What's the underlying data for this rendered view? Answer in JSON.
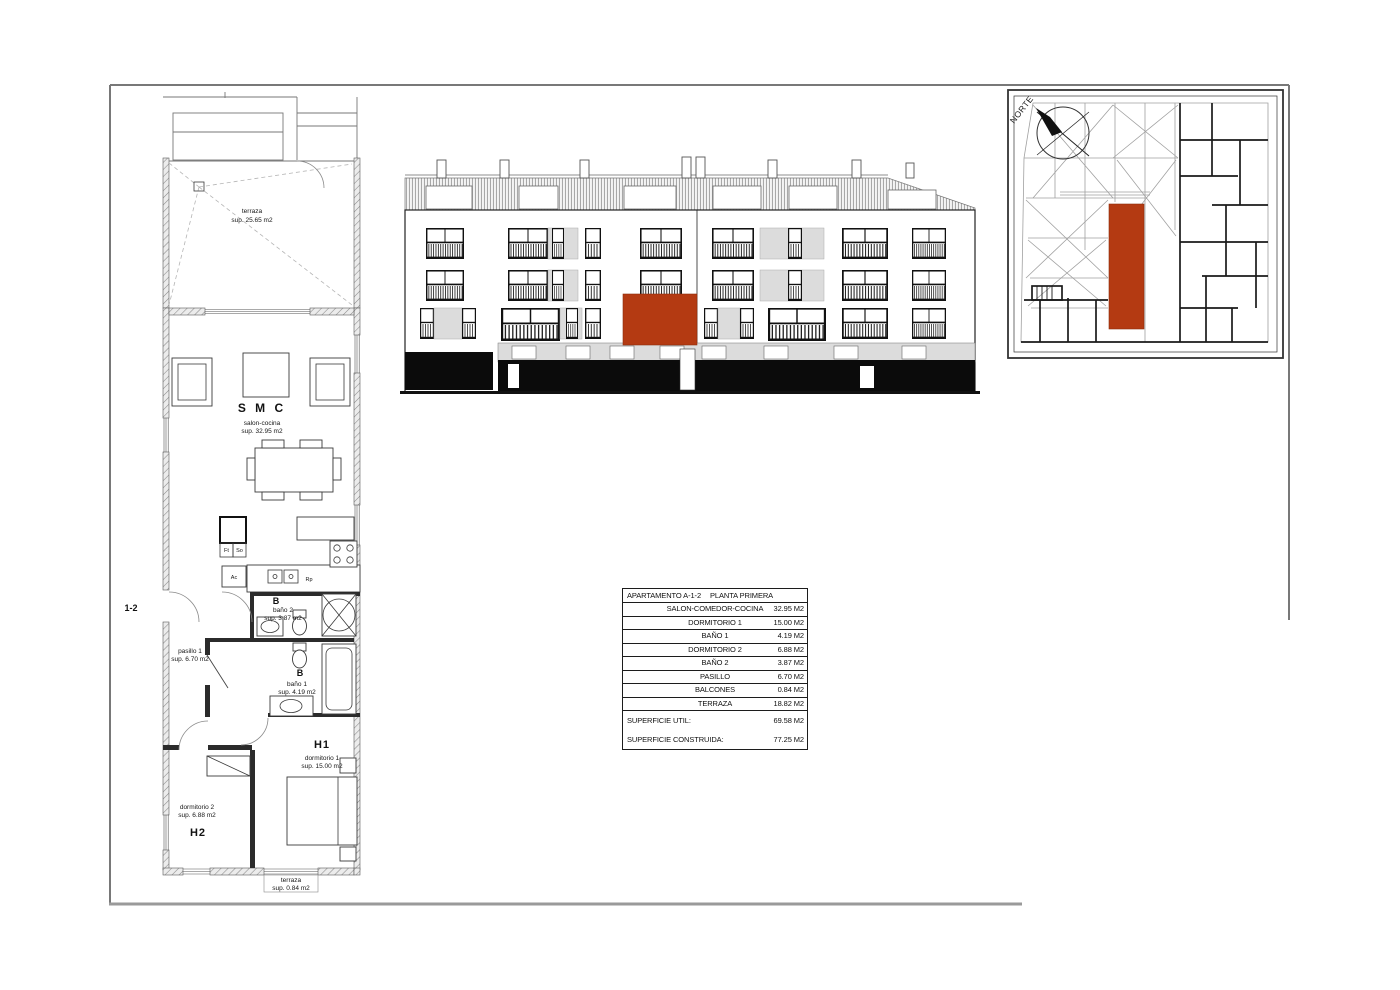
{
  "colors": {
    "accent": "#b43a12",
    "frame": "#8c8c8c"
  },
  "key_plan": {
    "north_label": "NORTE"
  },
  "floor_plan": {
    "terrace_top": {
      "name": "terraza",
      "area": "sup. 25.65 m2"
    },
    "living": {
      "code": "S M C",
      "name": "salon-cocina",
      "area": "sup. 32.95 m2"
    },
    "kitchen": {
      "fridge_label": "Ft",
      "so_label": "So",
      "ac_label": "Ac",
      "rp_label": "Rp"
    },
    "bath2": {
      "code": "B",
      "name": "baño 2",
      "area": "sup. 3.87 m2"
    },
    "hall": {
      "name": "pasillo 1",
      "area": "sup. 6.70 m2"
    },
    "entrance_code": "1-2",
    "bath1": {
      "code": "B",
      "name": "baño 1",
      "area": "sup. 4.19 m2"
    },
    "bedroom1": {
      "code": "H1",
      "name": "dormitorio 1",
      "area": "sup. 15.00 m2"
    },
    "bedroom2": {
      "code": "H2",
      "name": "dormitorio 2",
      "area": "sup. 6.88 m2"
    },
    "terrace_bottom": {
      "name": "terraza",
      "area": "sup. 0.84 m2"
    }
  },
  "areas_table": {
    "title_apartment": "APARTAMENTO  A-1-2",
    "title_floor": "PLANTA PRIMERA",
    "rows": [
      {
        "label": "SALON-COMEDOR-COCINA",
        "value": "32.95 M2"
      },
      {
        "label": "DORMITORIO 1",
        "value": "15.00 M2"
      },
      {
        "label": "BAÑO 1",
        "value": "4.19 M2"
      },
      {
        "label": "DORMITORIO 2",
        "value": "6.88 M2"
      },
      {
        "label": "BAÑO 2",
        "value": "3.87 M2"
      },
      {
        "label": "PASILLO",
        "value": "6.70 M2"
      },
      {
        "label": "BALCONES",
        "value": "0.84 M2"
      },
      {
        "label": "TERRAZA",
        "value": "18.82 M2"
      }
    ],
    "totals": [
      {
        "label": "SUPERFICIE UTIL:",
        "value": "69.58 M2"
      },
      {
        "label": "SUPERFICIE CONSTRUIDA:",
        "value": "77.25 M2"
      }
    ]
  }
}
